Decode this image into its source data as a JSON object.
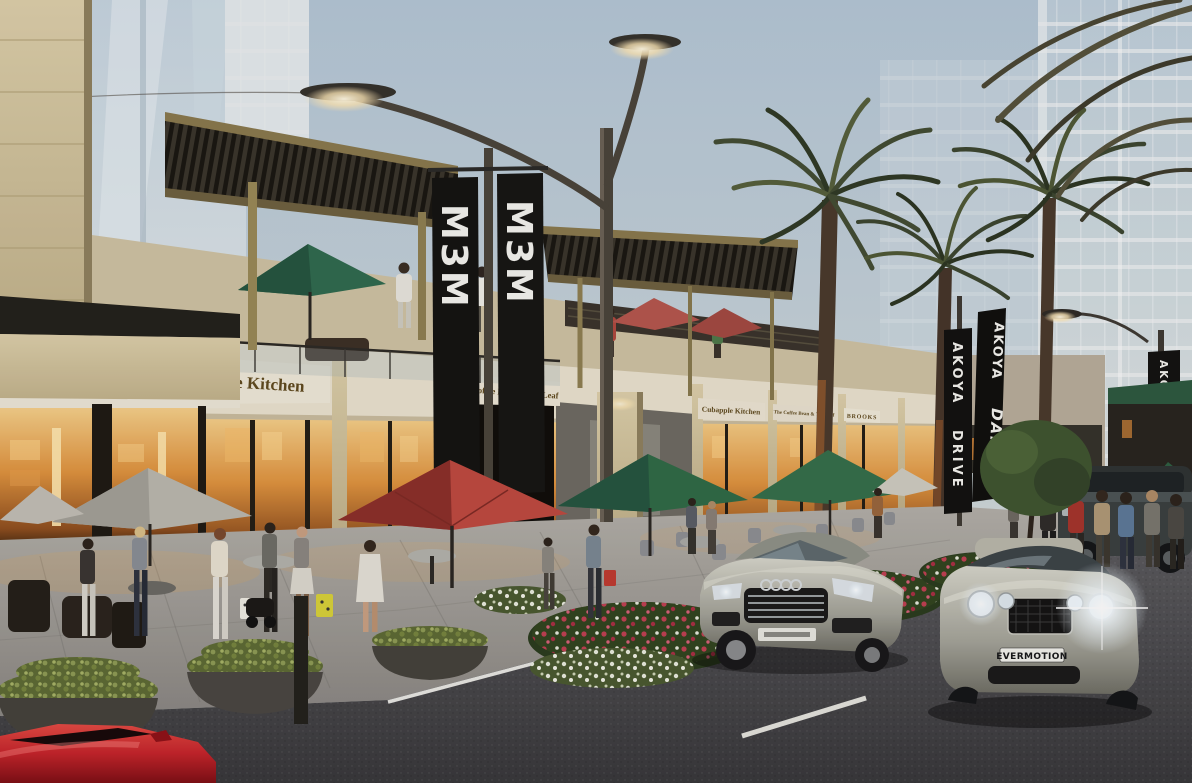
{
  "scene": {
    "description": "Dusk architectural rendering of a two-storey retail boulevard with palm trees, cafe terraces, pedestrians and luxury cars",
    "time_of_day": "dusk"
  },
  "banners": {
    "m3m_left": "M3M",
    "m3m_right": "M3M",
    "akoya_line1": "AKOYA",
    "akoya_line2": "DRIVE",
    "damac_line1": "AKOYA",
    "damac_line2": "DAMAC",
    "akoya_far": "AKOYA DRIVE"
  },
  "storefronts": {
    "sign1": "pple Kitchen",
    "sign2": "The Coffee Bean & Tea Leaf",
    "sign3": "ns",
    "sign4": "Cubapple Kitchen",
    "sign5": "The Coffee Bean & Tea Leaf",
    "sign6": "BROOKS"
  },
  "vehicles": {
    "bentley_plate": "EVERMOTION"
  },
  "colors": {
    "sky_top": "#b4c7d7",
    "sky_horizon": "#e3e3d8",
    "banner_black": "#141412",
    "banner_text": "#f4f4f0",
    "sign_text": "#5f4a1e",
    "fascia_cream": "#eae3d0",
    "storefront_glow": "#e0943f",
    "umbrella_red": "#a63832",
    "umbrella_green": "#2f6b47",
    "red_car": "#c5242b",
    "road_asphalt": "#46464a"
  }
}
